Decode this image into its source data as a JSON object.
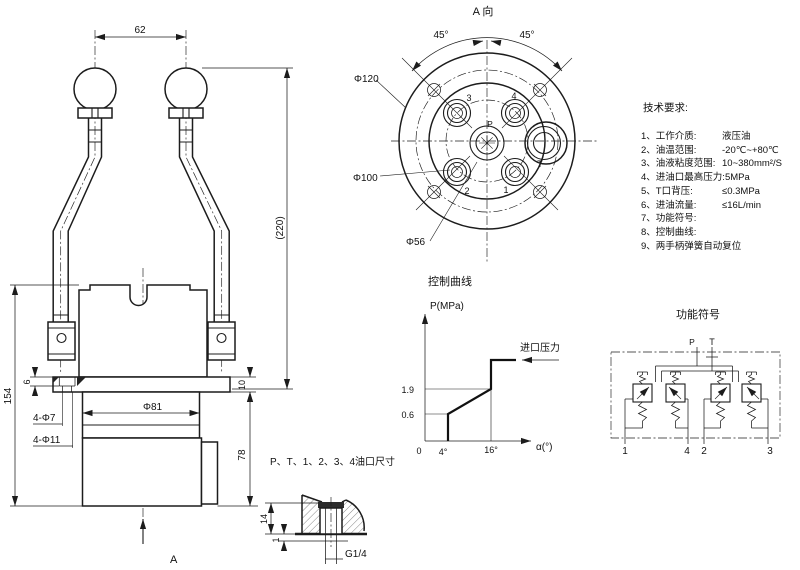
{
  "front": {
    "dim_62": "62",
    "dim_220": "(220)",
    "dim_154": "154",
    "dim_6": "6",
    "dim_10": "10",
    "dim_d81": "Φ81",
    "dim_4d7": "4-Φ7",
    "dim_4d11": "4-Φ11",
    "dim_78": "78",
    "arrow_label": "A"
  },
  "top": {
    "title": "A 向",
    "angle_left": "45°",
    "angle_right": "45°",
    "dim_d120": "Φ120",
    "dim_d100": "Φ100",
    "dim_d56": "Φ56",
    "port_p": "P",
    "port_t": "T",
    "port_1": "1",
    "port_2": "2",
    "port_3": "3",
    "port_4": "4"
  },
  "req": {
    "title": "技术要求:",
    "items": [
      {
        "label": "1、工作介质:",
        "value": "液压油"
      },
      {
        "label": "2、油温范围:",
        "value": "-20℃~+80℃"
      },
      {
        "label": "3、油液粘度范围:",
        "value": "10~380mm²/S"
      },
      {
        "label": "4、进油口最高压力:",
        "value": "5MPa"
      },
      {
        "label": "5、T口背压:",
        "value": "≤0.3MPa"
      },
      {
        "label": "6、进油流量:",
        "value": "≤16L/min"
      },
      {
        "label": "7、功能符号:",
        "value": ""
      },
      {
        "label": "8、控制曲线:",
        "value": ""
      },
      {
        "label": "9、两手柄弹簧自动复位",
        "value": ""
      }
    ]
  },
  "curve": {
    "title": "控制曲线",
    "ylabel": "P(MPa)",
    "xlabel": "α(°)",
    "tick_19": "1.9",
    "tick_06": "0.6",
    "tick_0": "0",
    "tick_4": "4°",
    "tick_16": "16°",
    "annotation": "进口压力"
  },
  "sym": {
    "title": "功能符号",
    "port_p": "P",
    "port_t": "T",
    "bottom_ports": [
      "1",
      "4",
      "2",
      "3"
    ]
  },
  "port": {
    "title": "P、T、1、2、3、4油口尺寸",
    "dim_14": "14",
    "dim_1": "1",
    "thread": "G1/4"
  },
  "chart_data": {
    "type": "line",
    "title": "控制曲线",
    "xlabel": "α(°)",
    "ylabel": "P(MPa)",
    "x": [
      4,
      4,
      16,
      16
    ],
    "y": [
      0,
      0.6,
      1.9,
      2.6
    ],
    "x_ticks": [
      0,
      4,
      16
    ],
    "y_ticks": [
      0.6,
      1.9
    ],
    "annotations": [
      "进口压力"
    ],
    "notes": "pilot pressure rises from 0.6 MPa at 4° to 1.9 MPa at 16° handle angle, then steps up to inlet pressure"
  }
}
